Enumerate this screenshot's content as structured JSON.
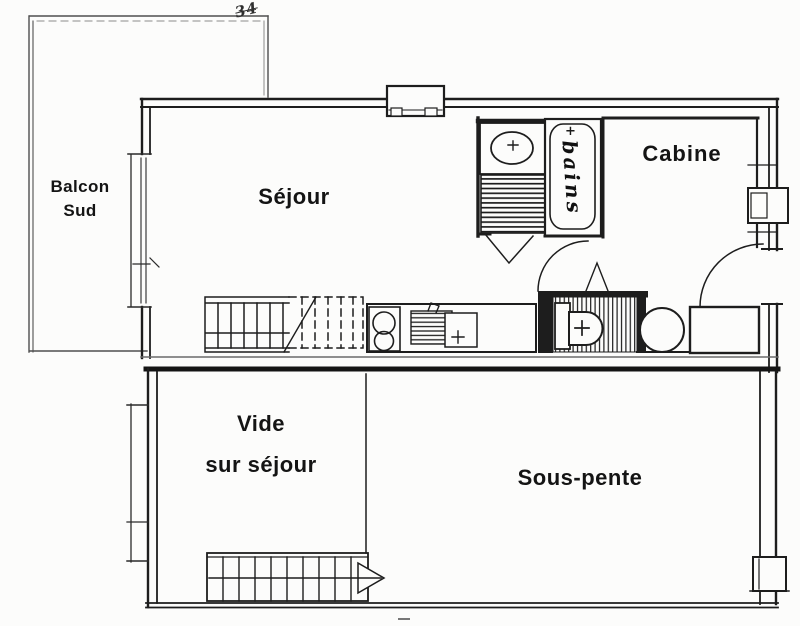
{
  "plan": {
    "paper_color": "#fcfcfb",
    "ink_color": "#1d1d1d",
    "handwritten_note": "34",
    "rooms": {
      "balcony": {
        "line1": "Balcon",
        "line2": "Sud"
      },
      "living_room": {
        "label": "Séjour"
      },
      "cabin": {
        "label": "Cabine"
      },
      "bathroom": {
        "label": "bains",
        "marker": "+"
      },
      "void_over_living": {
        "line1": "Vide",
        "line2": "sur séjour"
      },
      "under_eaves": {
        "label": "Sous-pente"
      }
    },
    "fixtures": [
      "bathtub",
      "washbasin",
      "toilet",
      "hob-burners",
      "kitchen-sink",
      "water-heater",
      "staircase-upper",
      "staircase-lower",
      "direction-arrow",
      "balcony-door-window",
      "windows",
      "door-swings"
    ]
  }
}
